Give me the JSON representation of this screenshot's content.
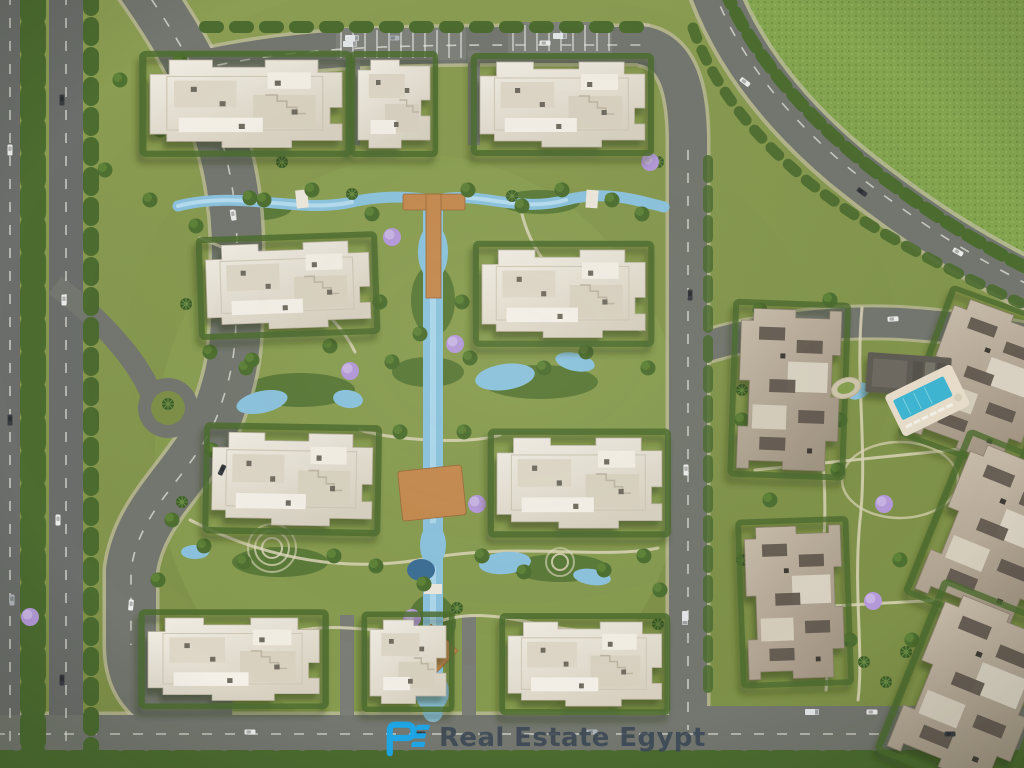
{
  "watermark": {
    "logo_text": "RE",
    "text": "Real Estate Egypt",
    "logo_color": "#1BA7EA",
    "text_color": "#3B4754"
  },
  "palette": {
    "grass": "#85974E",
    "field": "#84A450",
    "hedge": "#4C6C30",
    "road": "#73776F",
    "highway": "#6B6E6A",
    "curb": "#C9C2AC",
    "water": "#8CC3DE",
    "deep_water": "#3D6F94",
    "wood_deck": "#C58A50",
    "roof_cream": "#E8E3D6",
    "roof_taupe": "#B5A896",
    "pool": "#3FB6D2",
    "jacaranda": "#B49AD8",
    "walkway": "#DCD5B8"
  }
}
